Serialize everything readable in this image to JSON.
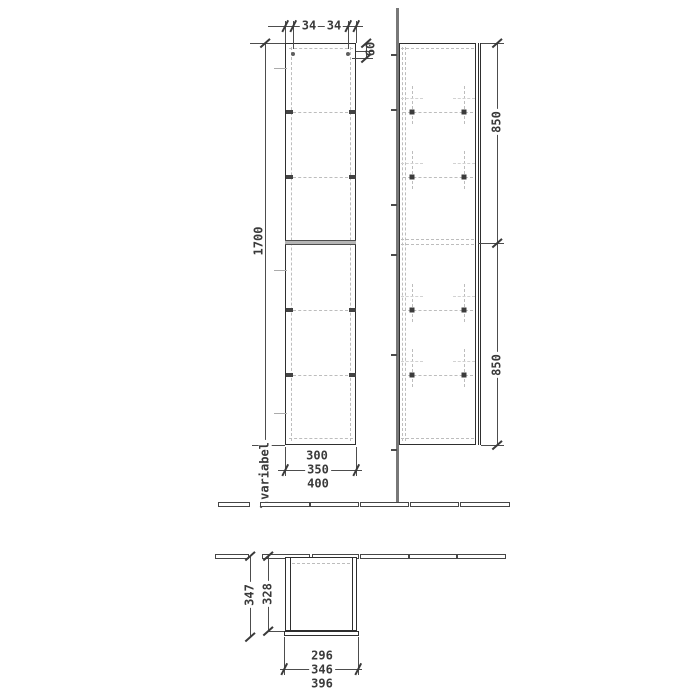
{
  "views": {
    "front": {
      "width_dim_left": "34",
      "width_dim_right": "34",
      "hinge_offset_dim": "60",
      "height_dim": "1700",
      "bottom_gap_dim": "variabel",
      "width_variants": [
        "300",
        "350",
        "400"
      ]
    },
    "side": {
      "upper_section_dim": "850",
      "lower_section_dim": "850"
    },
    "plan": {
      "depth_overall_dim": "347",
      "depth_body_dim": "328",
      "width_variants": [
        "296",
        "346",
        "396"
      ]
    }
  },
  "colors": {
    "line": "#2f2f2f",
    "dimension": "#4d4d4d",
    "dashed": "#bdbdbd",
    "wall": "#787878",
    "background": "#ffffff"
  }
}
